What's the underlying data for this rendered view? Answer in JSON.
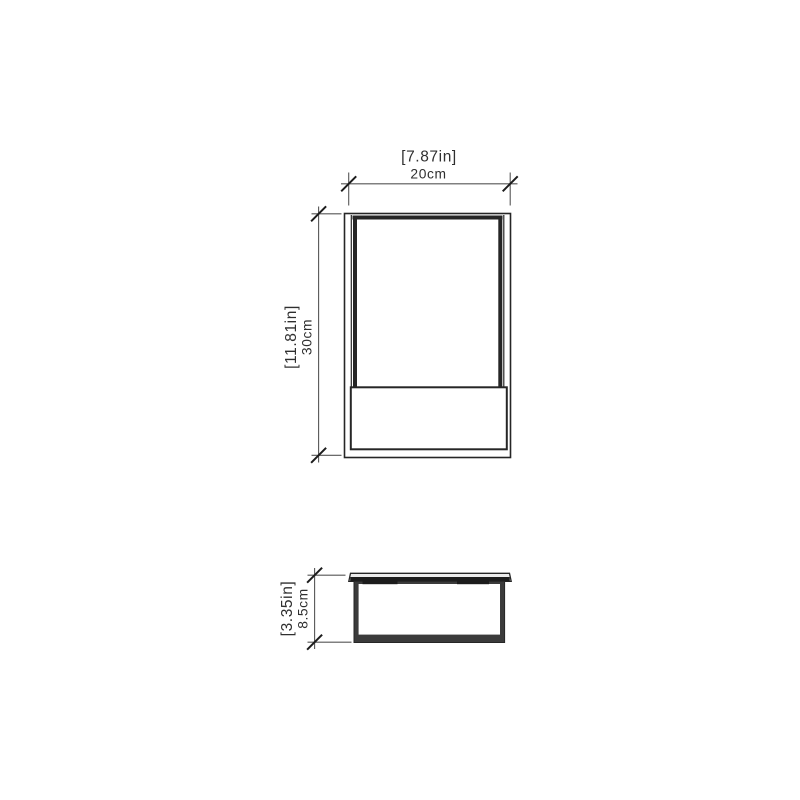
{
  "drawing": {
    "type": "technical-dimension-drawing",
    "views": {
      "front": {
        "name": "front-elevation"
      },
      "bottom": {
        "name": "bottom-section"
      }
    },
    "dimensions": {
      "width": {
        "imperial": "[7.87in]",
        "metric": "20cm"
      },
      "height": {
        "imperial": "[11.81in]",
        "metric": "30cm"
      },
      "depth": {
        "imperial": "[3.35in]",
        "metric": "8.5cm"
      }
    },
    "colors": {
      "line": "#262626",
      "dim": "#565656",
      "tick": "#1c1c1c",
      "text": "#2f2f2f",
      "background": "#ffffff",
      "lid_fill": "#ececec",
      "wall_fill": "#3b3b3b"
    }
  }
}
